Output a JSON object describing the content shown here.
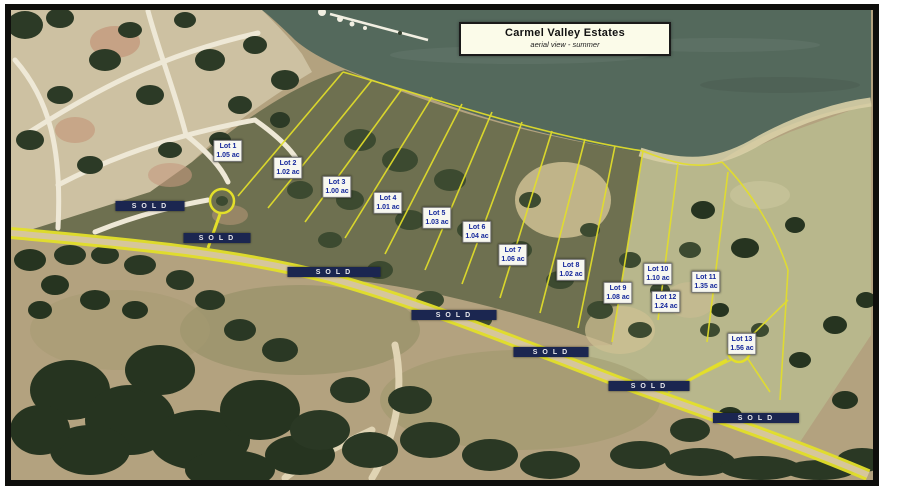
{
  "title_box": {
    "line1": "Carmel Valley Estates",
    "line2": "aerial view  -  summer"
  },
  "map": {
    "lots": [
      {
        "name": "Lot 1",
        "acreage": "1.05 ac",
        "x": 228,
        "y": 151
      },
      {
        "name": "Lot 2",
        "acreage": "1.02 ac",
        "x": 288,
        "y": 168
      },
      {
        "name": "Lot 3",
        "acreage": "1.00 ac",
        "x": 337,
        "y": 187
      },
      {
        "name": "Lot 4",
        "acreage": "1.01 ac",
        "x": 388,
        "y": 203
      },
      {
        "name": "Lot 5",
        "acreage": "1.03 ac",
        "x": 437,
        "y": 218
      },
      {
        "name": "Lot 6",
        "acreage": "1.04 ac",
        "x": 477,
        "y": 232
      },
      {
        "name": "Lot 7",
        "acreage": "1.06 ac",
        "x": 513,
        "y": 255
      },
      {
        "name": "Lot 8",
        "acreage": "1.02 ac",
        "x": 571,
        "y": 270
      },
      {
        "name": "Lot 9",
        "acreage": "1.08 ac",
        "x": 618,
        "y": 293
      },
      {
        "name": "Lot 10",
        "acreage": "1.10 ac",
        "x": 658,
        "y": 274
      },
      {
        "name": "Lot 11",
        "acreage": "1.35 ac",
        "x": 706,
        "y": 282
      },
      {
        "name": "Lot 12",
        "acreage": "1.24 ac",
        "x": 666,
        "y": 302
      },
      {
        "name": "Lot 13",
        "acreage": "1.56 ac",
        "x": 742,
        "y": 344
      }
    ],
    "sold_labels": [
      {
        "text": "SOLD",
        "x": 150,
        "y": 206,
        "w": 66
      },
      {
        "text": "SOLD",
        "x": 217,
        "y": 238,
        "w": 64
      },
      {
        "text": "SOLD",
        "x": 334,
        "y": 272,
        "w": 90
      },
      {
        "text": "SOLD",
        "x": 454,
        "y": 315,
        "w": 82
      },
      {
        "text": "SOLD",
        "x": 551,
        "y": 352,
        "w": 72
      },
      {
        "text": "SOLD",
        "x": 649,
        "y": 386,
        "w": 78
      },
      {
        "text": "SOLD",
        "x": 756,
        "y": 418,
        "w": 83
      }
    ],
    "colors": {
      "water": "#54695c",
      "road_highlight": "#e3df2a",
      "lot_line": "#e3df2a",
      "lot_label_text": "#14279b",
      "sold_label_bg": "#1b2650",
      "title_bg": "#fbfbe9",
      "frame": "#0e0e0c"
    }
  }
}
